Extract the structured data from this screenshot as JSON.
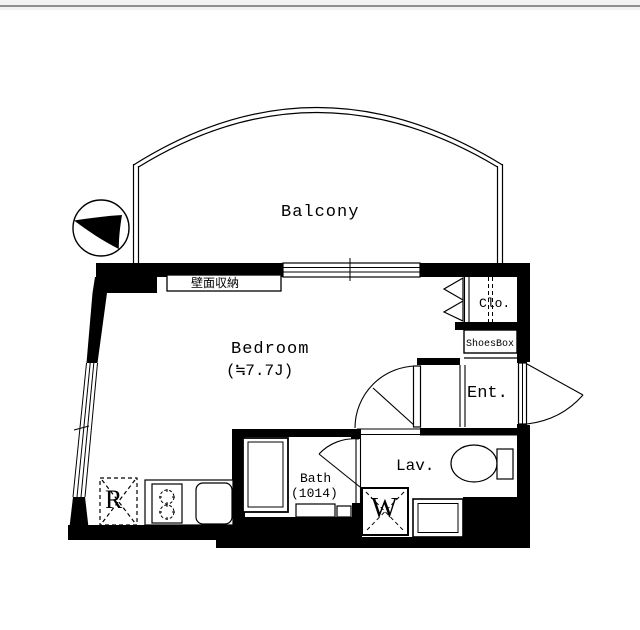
{
  "window": {
    "top_bar_color": "#f2f2f2",
    "top_bar_line_color": "#8f8f8f"
  },
  "floorplan": {
    "type": "apartment-floor-plan",
    "line_color": "#000000",
    "floor_color": "#ffffff",
    "labels": {
      "balcony": "Balcony",
      "bedroom_name": "Bedroom",
      "bedroom_size": "(≒7.7J)",
      "wall_storage": "壁面収納",
      "closet": "Clo.",
      "shoes_box": "ShoesBox",
      "entrance": "Ent.",
      "lavatory": "Lav.",
      "bath_name": "Bath",
      "bath_size": "(1014)",
      "washer": "W",
      "refrigerator": "R"
    }
  }
}
